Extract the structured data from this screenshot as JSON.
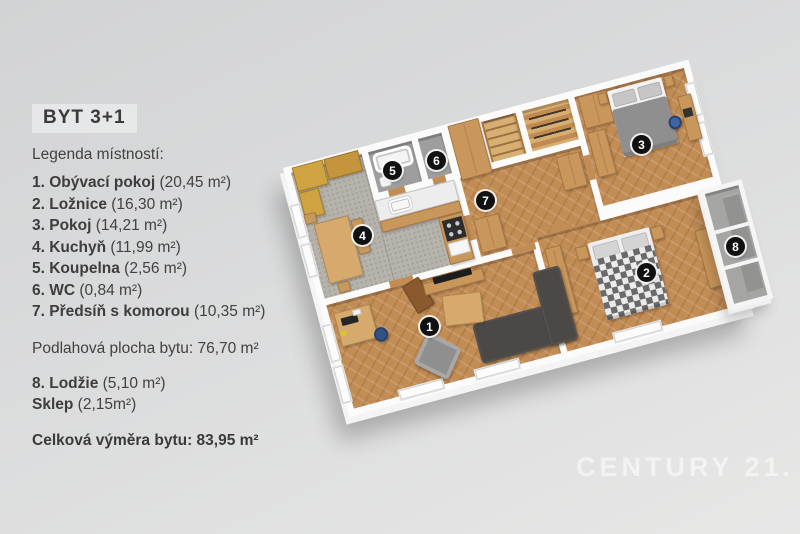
{
  "panel": {
    "title": "BYT 3+1",
    "legend_heading": "Legenda místností:",
    "rooms": [
      {
        "label": "1. Obývací pokoj",
        "area": "(20,45 m²)"
      },
      {
        "label": "2. Ložnice",
        "area": "(16,30 m²)"
      },
      {
        "label": "3. Pokoj",
        "area": "(14,21 m²)"
      },
      {
        "label": "4. Kuchyň",
        "area": "(11,99 m²)"
      },
      {
        "label": "5. Koupelna",
        "area": "(2,56 m²)"
      },
      {
        "label": "6. WC",
        "area": "(0,84 m²)"
      },
      {
        "label": "7. Předsíň s komorou",
        "area": "(10,35 m²)"
      }
    ],
    "floor_area_line": "Podlahová plocha bytu: 76,70 m²",
    "extras": [
      {
        "label": "8. Lodžie",
        "area": "(5,10 m²)"
      },
      {
        "label": "Sklep",
        "area": "(2,15m²)"
      }
    ],
    "total_line": "Celková výměra bytu: 83,95 m²"
  },
  "plan": {
    "badges": [
      {
        "n": "1"
      },
      {
        "n": "2"
      },
      {
        "n": "3"
      },
      {
        "n": "4"
      },
      {
        "n": "5"
      },
      {
        "n": "6"
      },
      {
        "n": "7"
      },
      {
        "n": "8"
      }
    ]
  },
  "watermark": "CENTURY 21.",
  "palette": {
    "background": "#d9dadb",
    "wall": "#fbfbfb",
    "wood_floor": "#c28c55",
    "kitchen_carpet": "#b6b2ac",
    "furniture_wood": "#c9965b",
    "cabinet_gold": "#d0a342",
    "badge": "#111111",
    "chair_blue": "#3f63a4"
  }
}
